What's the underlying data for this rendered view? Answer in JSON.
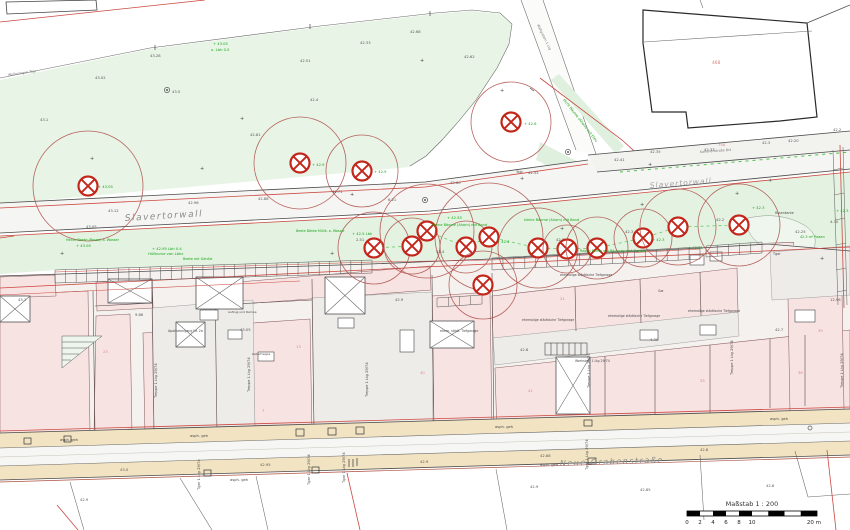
{
  "streets": {
    "main": "Slavertorwall",
    "main_right": "Slavertorwall",
    "bottom": "Neue Grabenstraße",
    "upper_note": "Kanonenstraße  Bst",
    "path_note": "Wallgraben 1 Ltg",
    "park_note": "Wallanlagen  Teja"
  },
  "scalebar": {
    "title": "Maßstab 1 : 200",
    "ticks": [
      "0",
      "2",
      "4",
      "6",
      "8",
      "10"
    ],
    "tick_meters": [
      0,
      2,
      4,
      6,
      8,
      10
    ],
    "end_label": "20 m",
    "total_meters": 20
  },
  "colors": {
    "park_green": "#e8f4e6",
    "strip_green": "#e4f2e2",
    "parcel_pink": "#f8e3e3",
    "sidewalk_tan": "#f2e4c2",
    "tree_red": "#c3271b",
    "crown_red": "#b0524c",
    "boundary_red": "#cc4840",
    "note_green": "#17a517"
  },
  "buildings": {
    "large_parcel_number": "468",
    "road_parcel_number": "758"
  },
  "map_features": {
    "trees": [
      {
        "x": 88,
        "y": 186,
        "crown_r": 55
      },
      {
        "x": 300,
        "y": 163,
        "crown_r": 46
      },
      {
        "x": 362,
        "y": 171,
        "crown_r": 36
      },
      {
        "x": 511,
        "y": 122,
        "crown_r": 40
      },
      {
        "x": 374,
        "y": 248,
        "crown_r": 36
      },
      {
        "x": 412,
        "y": 246,
        "crown_r": 28
      },
      {
        "x": 427,
        "y": 231,
        "crown_r": 47
      },
      {
        "x": 466,
        "y": 247,
        "crown_r": 26
      },
      {
        "x": 489,
        "y": 237,
        "crown_r": 54
      },
      {
        "x": 483,
        "y": 285,
        "crown_r": 34
      },
      {
        "x": 538,
        "y": 248,
        "crown_r": 40
      },
      {
        "x": 567,
        "y": 249,
        "crown_r": 24
      },
      {
        "x": 597,
        "y": 248,
        "crown_r": 31
      },
      {
        "x": 643,
        "y": 238,
        "crown_r": 29
      },
      {
        "x": 678,
        "y": 227,
        "crown_r": 38
      },
      {
        "x": 739,
        "y": 225,
        "crown_r": 41
      }
    ],
    "annotations": [
      {
        "x": 150,
        "y": 57,
        "t": "43.28",
        "c": "k"
      },
      {
        "x": 250,
        "y": 136,
        "t": "42.81",
        "c": "k"
      },
      {
        "x": 172,
        "y": 93,
        "t": "43.5",
        "c": "k"
      },
      {
        "x": 310,
        "y": 101,
        "t": "42.4",
        "c": "k"
      },
      {
        "x": 410,
        "y": 33,
        "t": "42.68",
        "c": "k"
      },
      {
        "x": 300,
        "y": 62,
        "t": "42.51",
        "c": "k"
      },
      {
        "x": 360,
        "y": 44,
        "t": "42.33",
        "c": "k"
      },
      {
        "x": 464,
        "y": 58,
        "t": "42.62",
        "c": "k"
      },
      {
        "x": 95,
        "y": 79,
        "t": "43.02",
        "c": "k"
      },
      {
        "x": 40,
        "y": 121,
        "t": "43.1",
        "c": "k"
      },
      {
        "x": 108,
        "y": 212,
        "t": "43.12",
        "c": "k"
      },
      {
        "x": 188,
        "y": 204,
        "t": "42.96",
        "c": "k"
      },
      {
        "x": 258,
        "y": 200,
        "t": "42.88",
        "c": "k"
      },
      {
        "x": 332,
        "y": 193,
        "t": "42.71",
        "c": "k"
      },
      {
        "x": 388,
        "y": 201,
        "t": "6.21",
        "c": "k"
      },
      {
        "x": 450,
        "y": 184,
        "t": "42.60",
        "c": "k"
      },
      {
        "x": 528,
        "y": 174,
        "t": "42.52",
        "c": "k"
      },
      {
        "x": 614,
        "y": 161,
        "t": "42.41",
        "c": "k"
      },
      {
        "x": 704,
        "y": 151,
        "t": "42.33",
        "c": "k"
      },
      {
        "x": 788,
        "y": 142,
        "t": "42.20",
        "c": "k"
      },
      {
        "x": 86,
        "y": 228,
        "t": "43.05",
        "c": "k"
      },
      {
        "x": 650,
        "y": 153,
        "t": "42.35",
        "c": "k"
      },
      {
        "x": 762,
        "y": 144,
        "t": "42.3",
        "c": "k"
      },
      {
        "x": 833,
        "y": 131,
        "t": "42.2",
        "c": "k"
      },
      {
        "x": 356,
        "y": 241,
        "t": "2.51",
        "c": "k"
      },
      {
        "x": 436,
        "y": 253,
        "t": "42.4",
        "c": "k"
      },
      {
        "x": 556,
        "y": 241,
        "t": "42.3",
        "c": "k"
      },
      {
        "x": 625,
        "y": 233,
        "t": "42.3",
        "c": "k"
      },
      {
        "x": 716,
        "y": 221,
        "t": "42.2",
        "c": "k"
      },
      {
        "x": 795,
        "y": 233,
        "t": "42.25",
        "c": "k"
      },
      {
        "x": 830,
        "y": 223,
        "t": "4.30",
        "c": "k"
      },
      {
        "x": 18,
        "y": 301,
        "t": "43.1",
        "c": "k"
      },
      {
        "x": 135,
        "y": 316,
        "t": "9.86",
        "c": "k"
      },
      {
        "x": 240,
        "y": 331,
        "t": "43.05",
        "c": "k"
      },
      {
        "x": 395,
        "y": 301,
        "t": "42.9",
        "c": "k"
      },
      {
        "x": 520,
        "y": 351,
        "t": "42.8",
        "c": "k"
      },
      {
        "x": 650,
        "y": 341,
        "t": "4.30",
        "c": "k"
      },
      {
        "x": 775,
        "y": 331,
        "t": "42.7",
        "c": "k"
      },
      {
        "x": 830,
        "y": 301,
        "t": "12.96",
        "c": "k"
      },
      {
        "x": 260,
        "y": 466,
        "t": "42.95",
        "c": "k"
      },
      {
        "x": 540,
        "y": 457,
        "t": "42.88",
        "c": "k"
      },
      {
        "x": 700,
        "y": 451,
        "t": "42.8",
        "c": "k"
      },
      {
        "x": 120,
        "y": 471,
        "t": "43.0",
        "c": "k"
      },
      {
        "x": 420,
        "y": 463,
        "t": "42.9",
        "c": "k"
      },
      {
        "x": 640,
        "y": 491,
        "t": "42.85",
        "c": "k"
      },
      {
        "x": 80,
        "y": 501,
        "t": "42.9",
        "c": "k"
      },
      {
        "x": 530,
        "y": 488,
        "t": "42.9",
        "c": "k"
      },
      {
        "x": 766,
        "y": 487,
        "t": "42.8",
        "c": "k"
      },
      {
        "x": 60,
        "y": 441,
        "t": "asph. geh",
        "c": "d"
      },
      {
        "x": 190,
        "y": 437,
        "t": "asph. geh",
        "c": "d"
      },
      {
        "x": 495,
        "y": 428,
        "t": "asph. geh",
        "c": "d"
      },
      {
        "x": 770,
        "y": 420,
        "t": "asph. geh",
        "c": "d"
      },
      {
        "x": 230,
        "y": 481,
        "t": "asph. geh",
        "c": "d"
      },
      {
        "x": 540,
        "y": 466,
        "t": "asph. geh",
        "c": "d"
      },
      {
        "x": 213,
        "y": 45,
        "t": "+ 43.05",
        "c": "g"
      },
      {
        "x": 211,
        "y": 51,
        "t": "u. Lbh 0.5",
        "c": "g"
      },
      {
        "x": 563,
        "y": 100,
        "t": "dicht Bäume (Ahorn) mit Efeu",
        "c": "g",
        "r": 52,
        "s": 3.6
      },
      {
        "x": 66,
        "y": 241,
        "t": "Hecke Beete (Rosen) a. Wasser",
        "c": "g",
        "s": 3.4
      },
      {
        "x": 76,
        "y": 247,
        "t": "+ 43.05",
        "c": "g"
      },
      {
        "x": 152,
        "y": 250,
        "t": "+ 42.95  Lbh 0.4",
        "c": "g"
      },
      {
        "x": 148,
        "y": 255,
        "t": "Hüllkurve von Lbhz",
        "c": "g"
      },
      {
        "x": 183,
        "y": 260,
        "t": "Beete mit Gehölz",
        "c": "g",
        "s": 3.4
      },
      {
        "x": 352,
        "y": 235,
        "t": "+ 42.5  Lbh",
        "c": "g"
      },
      {
        "x": 432,
        "y": 226,
        "t": "kleine Bäume (Ahorn) mit Band",
        "c": "g",
        "s": 3.5
      },
      {
        "x": 524,
        "y": 221,
        "t": "kleine Bäume (Ahorn) mit Band",
        "c": "g",
        "s": 3.5
      },
      {
        "x": 580,
        "y": 252,
        "t": "Rasen  Beete mit Bäumen und Gehölz",
        "c": "g",
        "s": 3.5
      },
      {
        "x": 688,
        "y": 249,
        "t": "+ 42.35",
        "c": "g"
      },
      {
        "x": 752,
        "y": 209,
        "t": "+ 42.3",
        "c": "g"
      },
      {
        "x": 800,
        "y": 238,
        "t": "42.3 m² Rasen",
        "c": "g",
        "s": 3.4
      },
      {
        "x": 98,
        "y": 188,
        "t": "+ 43.05",
        "c": "g"
      },
      {
        "x": 312,
        "y": 166,
        "t": "+ 42.9",
        "c": "g"
      },
      {
        "x": 374,
        "y": 173,
        "t": "+ 42.9",
        "c": "g"
      },
      {
        "x": 524,
        "y": 125,
        "t": "+ 42.6",
        "c": "g"
      },
      {
        "x": 497,
        "y": 243,
        "t": "+ 42.4",
        "c": "g"
      },
      {
        "x": 652,
        "y": 241,
        "t": "+ 42.3",
        "c": "g"
      },
      {
        "x": 296,
        "y": 232,
        "t": "Beete  Bänke  Müllk. a. Wasser",
        "c": "g",
        "s": 3.3
      },
      {
        "x": 447,
        "y": 219,
        "t": "+ 42.55",
        "c": "g"
      },
      {
        "x": 836,
        "y": 212,
        "t": "+ 42.3",
        "c": "g"
      },
      {
        "x": 712,
        "y": 64,
        "t": "468",
        "c": "r",
        "s": 4.4
      },
      {
        "x": 718,
        "y": 146,
        "t": "758",
        "c": "r"
      },
      {
        "x": 103,
        "y": 353,
        "t": "23",
        "c": "r"
      },
      {
        "x": 296,
        "y": 348,
        "t": "13",
        "c": "r"
      },
      {
        "x": 528,
        "y": 392,
        "t": "41",
        "c": "r"
      },
      {
        "x": 700,
        "y": 382,
        "t": "25",
        "c": "r"
      },
      {
        "x": 798,
        "y": 374,
        "t": "36",
        "c": "r"
      },
      {
        "x": 818,
        "y": 332,
        "t": "39",
        "c": "r"
      },
      {
        "x": 420,
        "y": 374,
        "t": "40",
        "c": "r"
      },
      {
        "x": 262,
        "y": 412,
        "t": "7",
        "c": "r"
      },
      {
        "x": 560,
        "y": 300,
        "t": "21",
        "c": "r"
      },
      {
        "x": 522,
        "y": 321,
        "t": "ehemalige städtische Tiefgarage",
        "c": "d",
        "s": 3.2
      },
      {
        "x": 608,
        "y": 317,
        "t": "ehemalige städtische Tiefgarage",
        "c": "d",
        "s": 3.2
      },
      {
        "x": 688,
        "y": 312,
        "t": "ehemalige städtische Tiefgarage",
        "c": "d",
        "s": 3.2
      },
      {
        "x": 560,
        "y": 276,
        "t": "ehemalige städtische Tiefgarage",
        "c": "d",
        "s": 3.2
      },
      {
        "x": 440,
        "y": 332,
        "t": "ehem. städt. Tiefgarage",
        "c": "d",
        "s": 3.2
      },
      {
        "x": 575,
        "y": 362,
        "t": "Werkstatt 1 Ltg 29/74",
        "c": "d",
        "s": 3.2
      },
      {
        "x": 168,
        "y": 332,
        "t": "Apothekergang Nr. 2a",
        "c": "d",
        "s": 3.2
      },
      {
        "x": 228,
        "y": 313,
        "t": "Aufzug und Rampe",
        "c": "d",
        "s": 3.0
      },
      {
        "x": 252,
        "y": 355,
        "t": "Kellertreppe",
        "c": "d",
        "s": 3.0
      },
      {
        "x": 658,
        "y": 292,
        "t": "Gar",
        "c": "d",
        "s": 3.2
      },
      {
        "x": 773,
        "y": 255,
        "t": "Tgar",
        "c": "d",
        "s": 3.4
      },
      {
        "x": 157,
        "y": 398,
        "t": "Treppe 1 Ltg 29/74",
        "c": "d",
        "r": -90
      },
      {
        "x": 250,
        "y": 392,
        "t": "Treppe 1 Ltg 29/74",
        "c": "d",
        "r": -90
      },
      {
        "x": 368,
        "y": 397,
        "t": "Treppe 1 Ltg 29/74",
        "c": "d",
        "r": -90
      },
      {
        "x": 590,
        "y": 388,
        "t": "Treppe 1 Ltg 29/74",
        "c": "d",
        "r": -90
      },
      {
        "x": 733,
        "y": 375,
        "t": "Treppe 1 Ltg 29/74",
        "c": "d",
        "r": -90
      },
      {
        "x": 843,
        "y": 388,
        "t": "Treppe 1 Ltg 29/74",
        "c": "d",
        "r": -90
      },
      {
        "x": 200,
        "y": 490,
        "t": "Tgar 1 Ltg 29/74",
        "c": "d",
        "r": -90
      },
      {
        "x": 310,
        "y": 485,
        "t": "Tgar 1 Ltg 29/74",
        "c": "d",
        "r": -90
      },
      {
        "x": 345,
        "y": 483,
        "t": "Tgar 1 Ltg 29/74",
        "c": "d",
        "r": -90
      },
      {
        "x": 588,
        "y": 470,
        "t": "Tgar 1 Ltg 29/74",
        "c": "d",
        "r": -90
      },
      {
        "x": 516,
        "y": 173,
        "t": "Teja",
        "c": "d",
        "s": 3.4
      },
      {
        "x": 775,
        "y": 214,
        "t": "Rasenkante",
        "c": "d",
        "s": 3.2
      },
      {
        "x": 350,
        "y": 196,
        "t": "+",
        "c": "p",
        "s": 5
      },
      {
        "x": 520,
        "y": 180,
        "t": "+",
        "c": "p",
        "s": 5
      },
      {
        "x": 648,
        "y": 166,
        "t": "+",
        "c": "p",
        "s": 5
      },
      {
        "x": 240,
        "y": 120,
        "t": "+",
        "c": "p",
        "s": 5
      },
      {
        "x": 420,
        "y": 62,
        "t": "+",
        "c": "p",
        "s": 5
      },
      {
        "x": 90,
        "y": 160,
        "t": "+",
        "c": "p",
        "s": 5
      },
      {
        "x": 768,
        "y": 182,
        "t": "+",
        "c": "p",
        "s": 5
      },
      {
        "x": 640,
        "y": 206,
        "t": "+",
        "c": "p",
        "s": 5
      },
      {
        "x": 500,
        "y": 92,
        "t": "+",
        "c": "p",
        "s": 5
      },
      {
        "x": 200,
        "y": 170,
        "t": "+",
        "c": "p",
        "s": 5
      },
      {
        "x": 735,
        "y": 195,
        "t": "+",
        "c": "p",
        "s": 5
      },
      {
        "x": 60,
        "y": 255,
        "t": "+",
        "c": "p",
        "s": 5
      },
      {
        "x": 820,
        "y": 260,
        "t": "+",
        "c": "p",
        "s": 5
      },
      {
        "x": 330,
        "y": 255,
        "t": "+",
        "c": "p",
        "s": 5
      },
      {
        "x": 560,
        "y": 230,
        "t": "+",
        "c": "p",
        "s": 5
      }
    ]
  }
}
